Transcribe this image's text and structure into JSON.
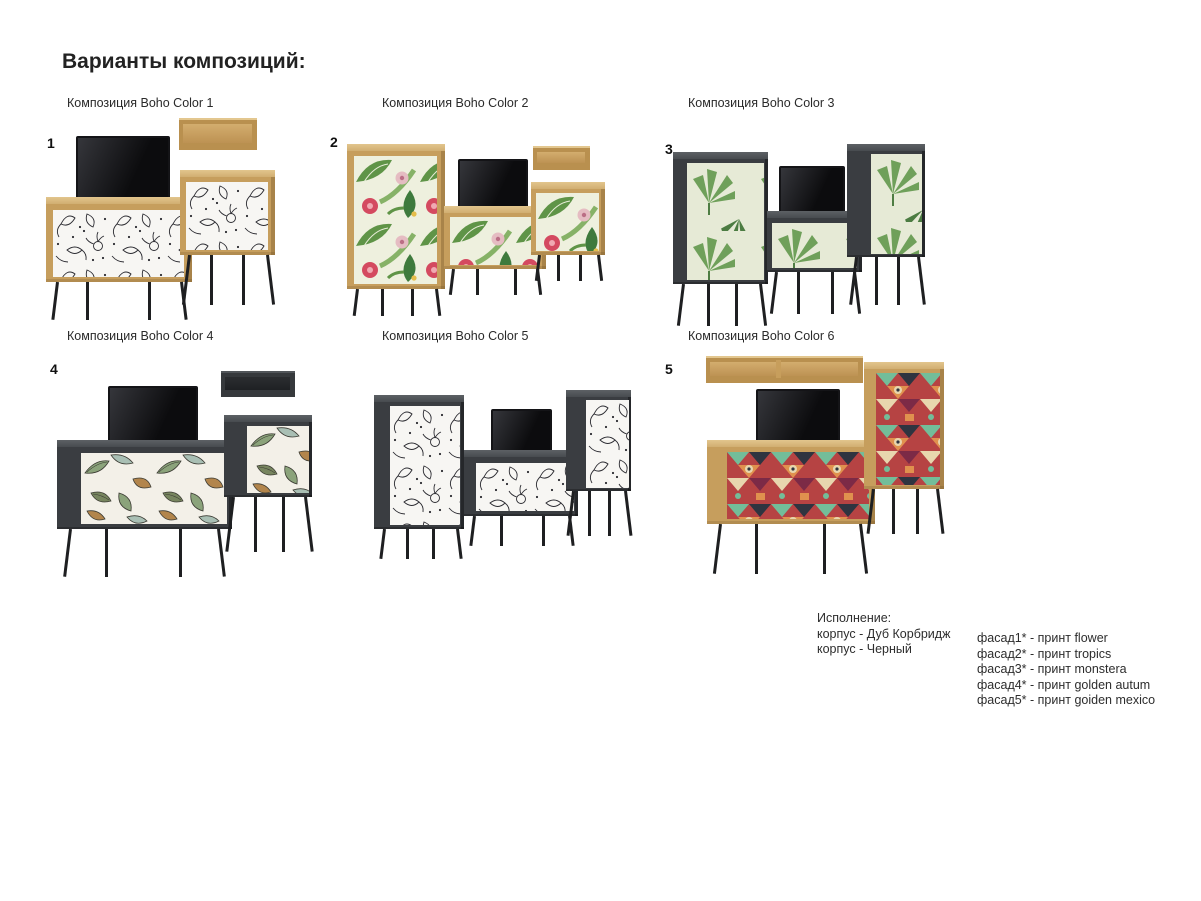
{
  "page": {
    "title": "Варианты композиций:"
  },
  "compositions": [
    {
      "number": "1",
      "caption": "Композиция Boho Color 1",
      "print": "flower",
      "body": "Дуб Корбридж"
    },
    {
      "number": "2",
      "caption": "Композиция Boho Color 2",
      "print": "tropics",
      "body": "Дуб Корбридж"
    },
    {
      "number": "3",
      "caption": "Композиция Boho Color 3",
      "print": "monstera",
      "body": "Черный"
    },
    {
      "number": "4",
      "caption": "Композиция Boho Color 4",
      "print": "golden autum",
      "body": "Черный"
    },
    {
      "number": "",
      "caption": "Композиция Boho Color 5",
      "print": "flower",
      "body": "Черный"
    },
    {
      "number": "5",
      "caption": "Композиция Boho Color 6",
      "print": "goiden mexico",
      "body": "Дуб Корбридж"
    }
  ],
  "legend": {
    "title": "Исполнение:",
    "body_lines": [
      "корпус - Дуб Корбридж",
      "корпус - Черный"
    ],
    "facade_lines": [
      "фасад1* - принт flower",
      "фасад2* - принт tropics",
      "фасад3* - принт monstera",
      "фасад4* - принт golden autum",
      "фасад5* - принт goiden mexico"
    ]
  },
  "colors": {
    "oak": "#c69e5d",
    "dark_body": "#3a3d41",
    "legs": "#1e1f21",
    "background": "#ffffff"
  }
}
